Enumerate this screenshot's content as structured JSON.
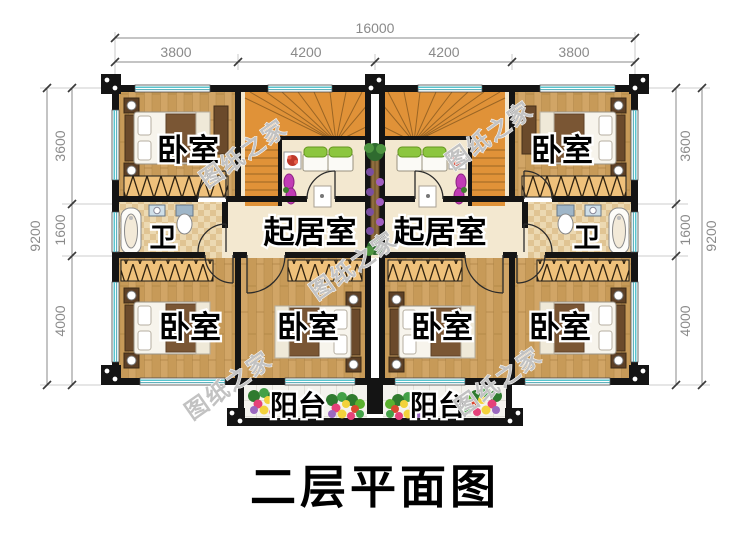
{
  "title": "二层平面图",
  "watermark": "图纸之家",
  "dimensions": {
    "horizontal": {
      "total": "16000",
      "segments": [
        "3800",
        "4200",
        "4200",
        "3800"
      ]
    },
    "vertical": {
      "total": "9200",
      "segments": [
        "3600",
        "1600",
        "4000"
      ]
    }
  },
  "rooms": {
    "bedroom": "卧室",
    "living_room": "起居室",
    "bathroom": "卫",
    "balcony": "阳台"
  },
  "colors": {
    "wall": "#141414",
    "wood_floor": "#d1a566",
    "stair_wood": "#e09238",
    "corridor_floor": "#f3e8d0",
    "window_accent": "#58c4ce",
    "wardrobe_hatch": "#efc17b",
    "dimension_text": "#8a8a8a",
    "label_fill": "#000000"
  }
}
